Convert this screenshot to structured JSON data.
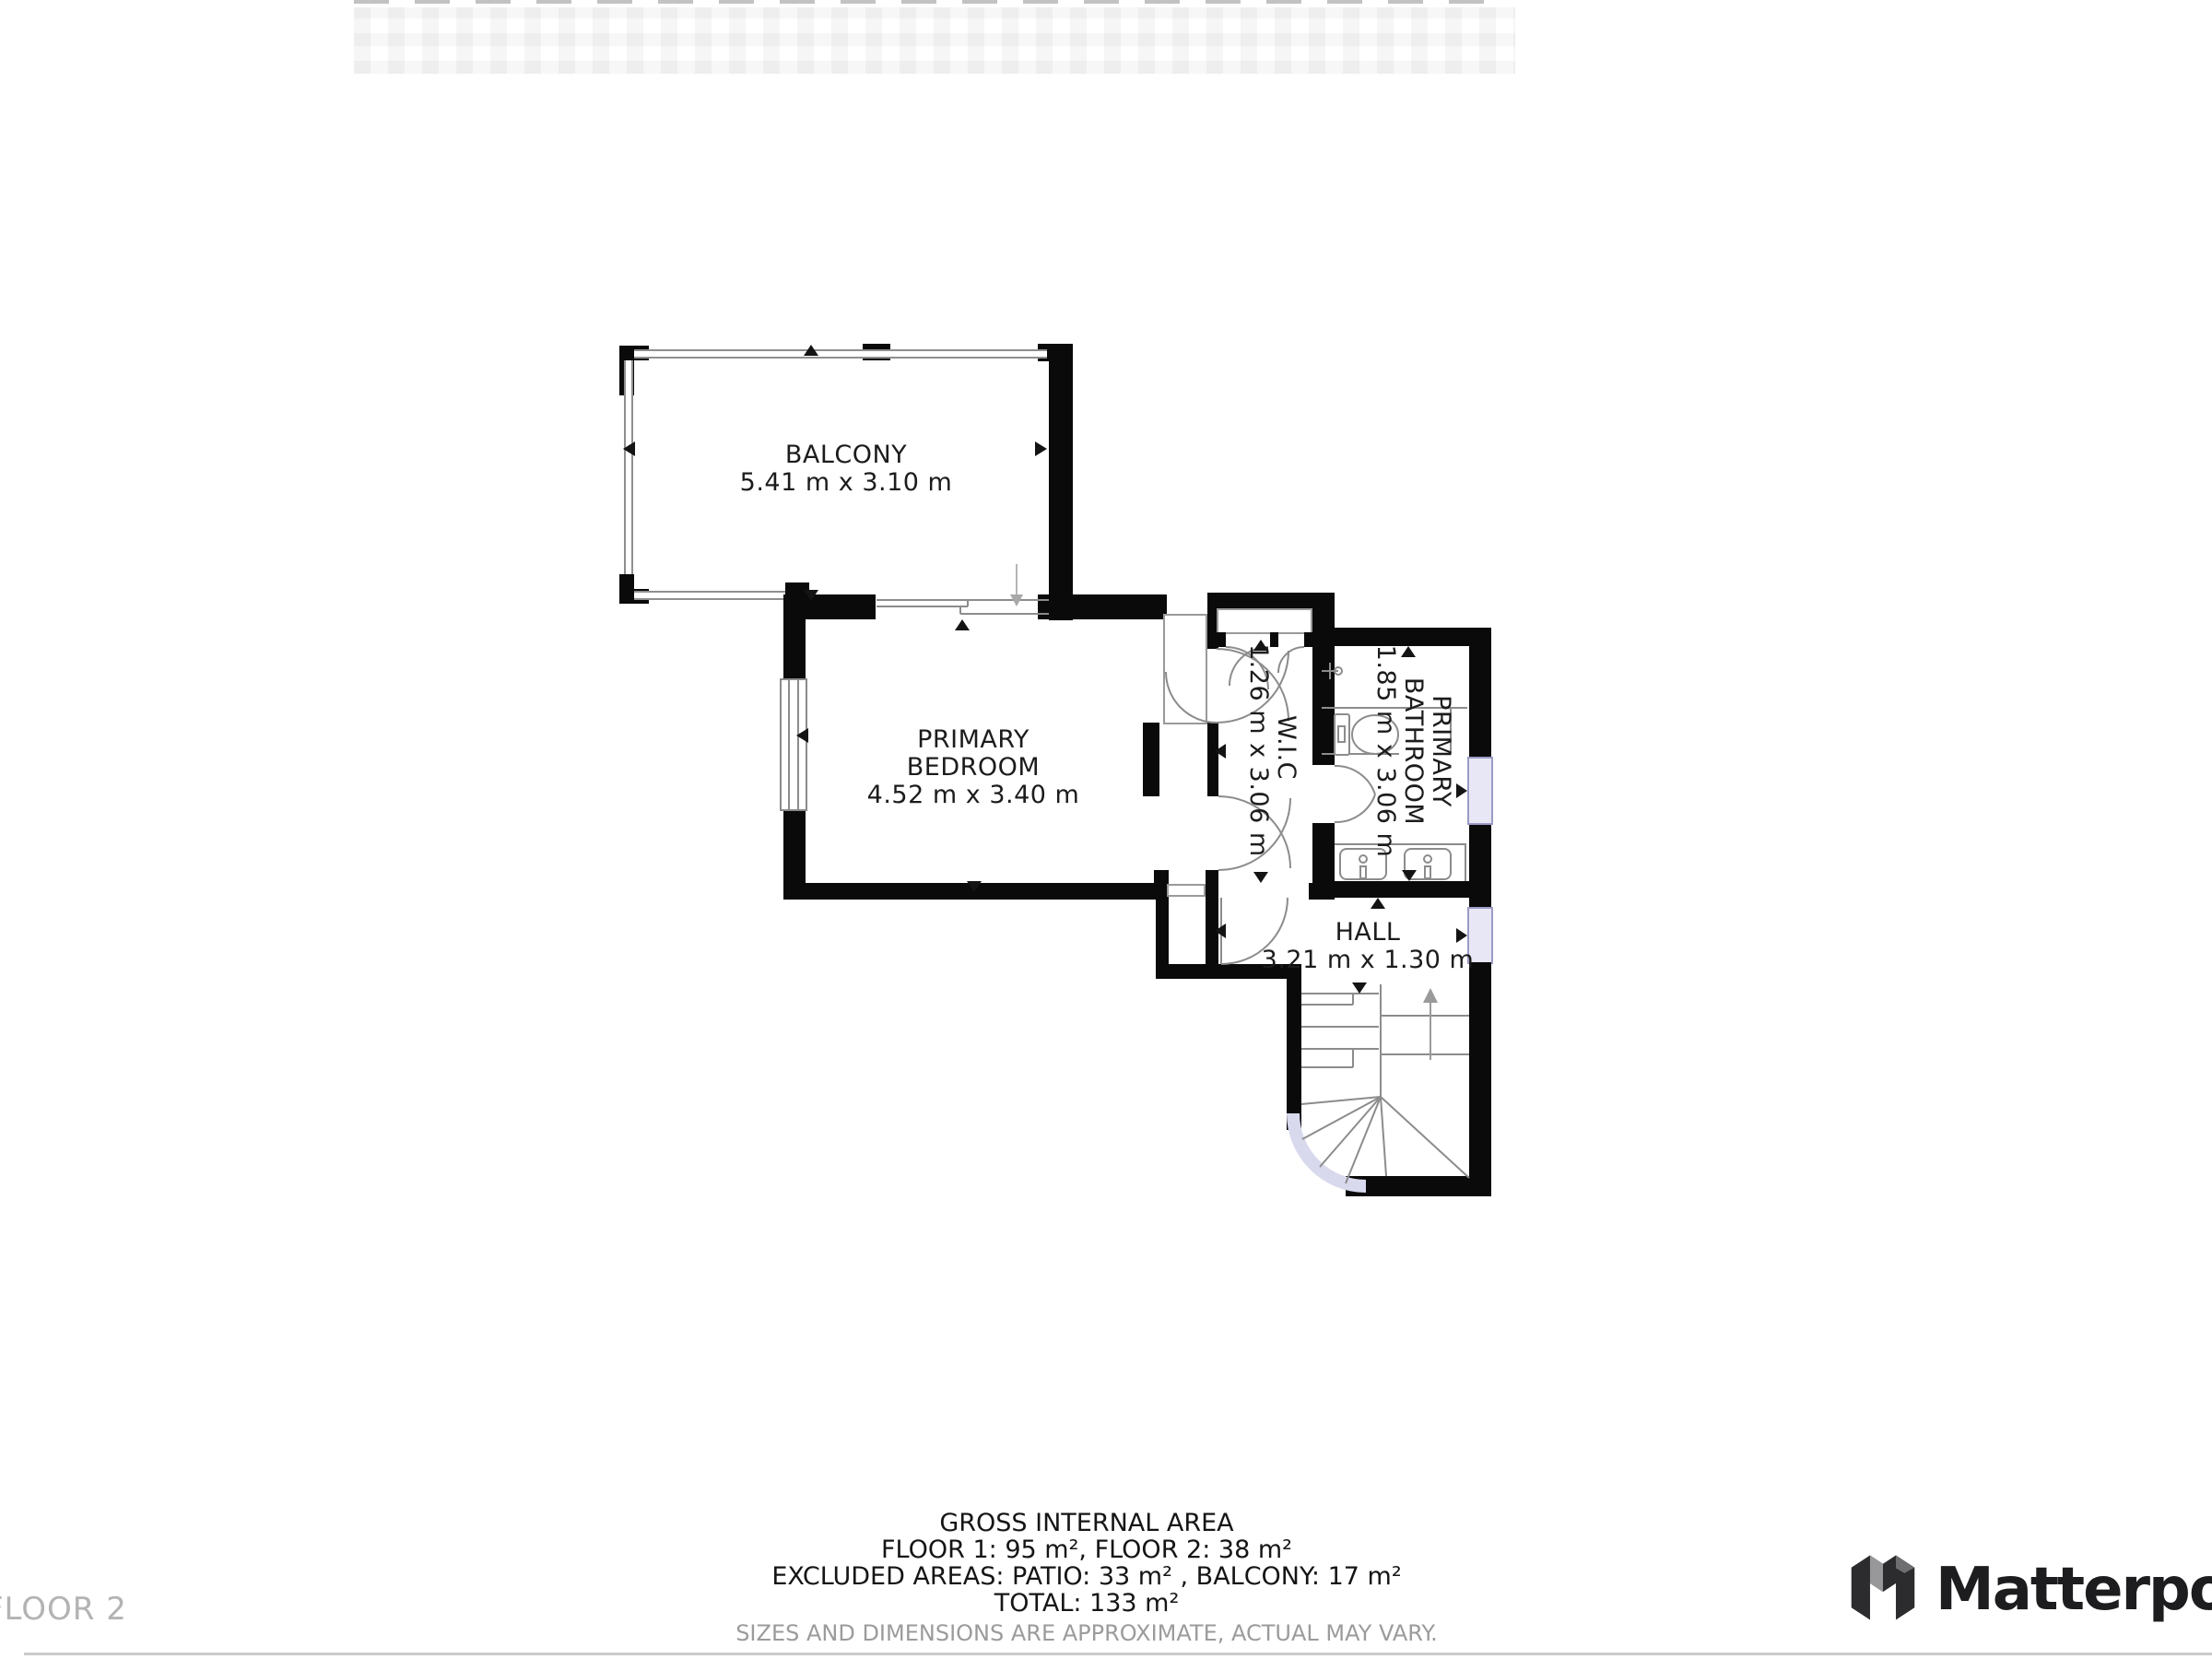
{
  "rooms": {
    "balcony": {
      "name": "BALCONY",
      "dims": "5.41 m x 3.10 m"
    },
    "bedroom": {
      "name_line1": "PRIMARY",
      "name_line2": "BEDROOM",
      "dims": "4.52 m x 3.40 m"
    },
    "wic": {
      "name": "W.I.C",
      "dims": "1.26 m x 3.06 m"
    },
    "bathroom": {
      "name_line1": "PRIMARY",
      "name_line2": "BATHROOM",
      "dims": "1.85 m x 3.06 m"
    },
    "hall": {
      "name": "HALL",
      "dims": "3.21 m x 1.30 m"
    }
  },
  "footer": {
    "line1": "GROSS INTERNAL AREA",
    "line2": "FLOOR 1: 95 m², FLOOR 2: 38 m²",
    "line3": "EXCLUDED AREAS: PATIO: 33 m² , BALCONY: 17 m²",
    "line4": "TOTAL: 133 m²",
    "disclaimer": "SIZES AND DIMENSIONS ARE APPROXIMATE, ACTUAL MAY VARY."
  },
  "floor_label": "FLOOR 2",
  "brand": {
    "name": "Matterport"
  },
  "colors": {
    "wall": "#0a0a0a",
    "window_fill": "#e7e7f6",
    "window_border": "#9b9bc6",
    "linework": "#8c8c8c",
    "label_text": "#1c1c1c",
    "muted_text": "#9b9b9b",
    "brand_text": "#1d1d1f"
  },
  "icons": [
    "direction-arrow-up",
    "direction-arrow-down",
    "direction-arrow-left",
    "direction-arrow-right",
    "stairs-up-arrow",
    "sliding-door-arrow",
    "door-swing-arc",
    "toilet-icon",
    "sink-icon",
    "faucet-icon",
    "matterport-logo"
  ]
}
